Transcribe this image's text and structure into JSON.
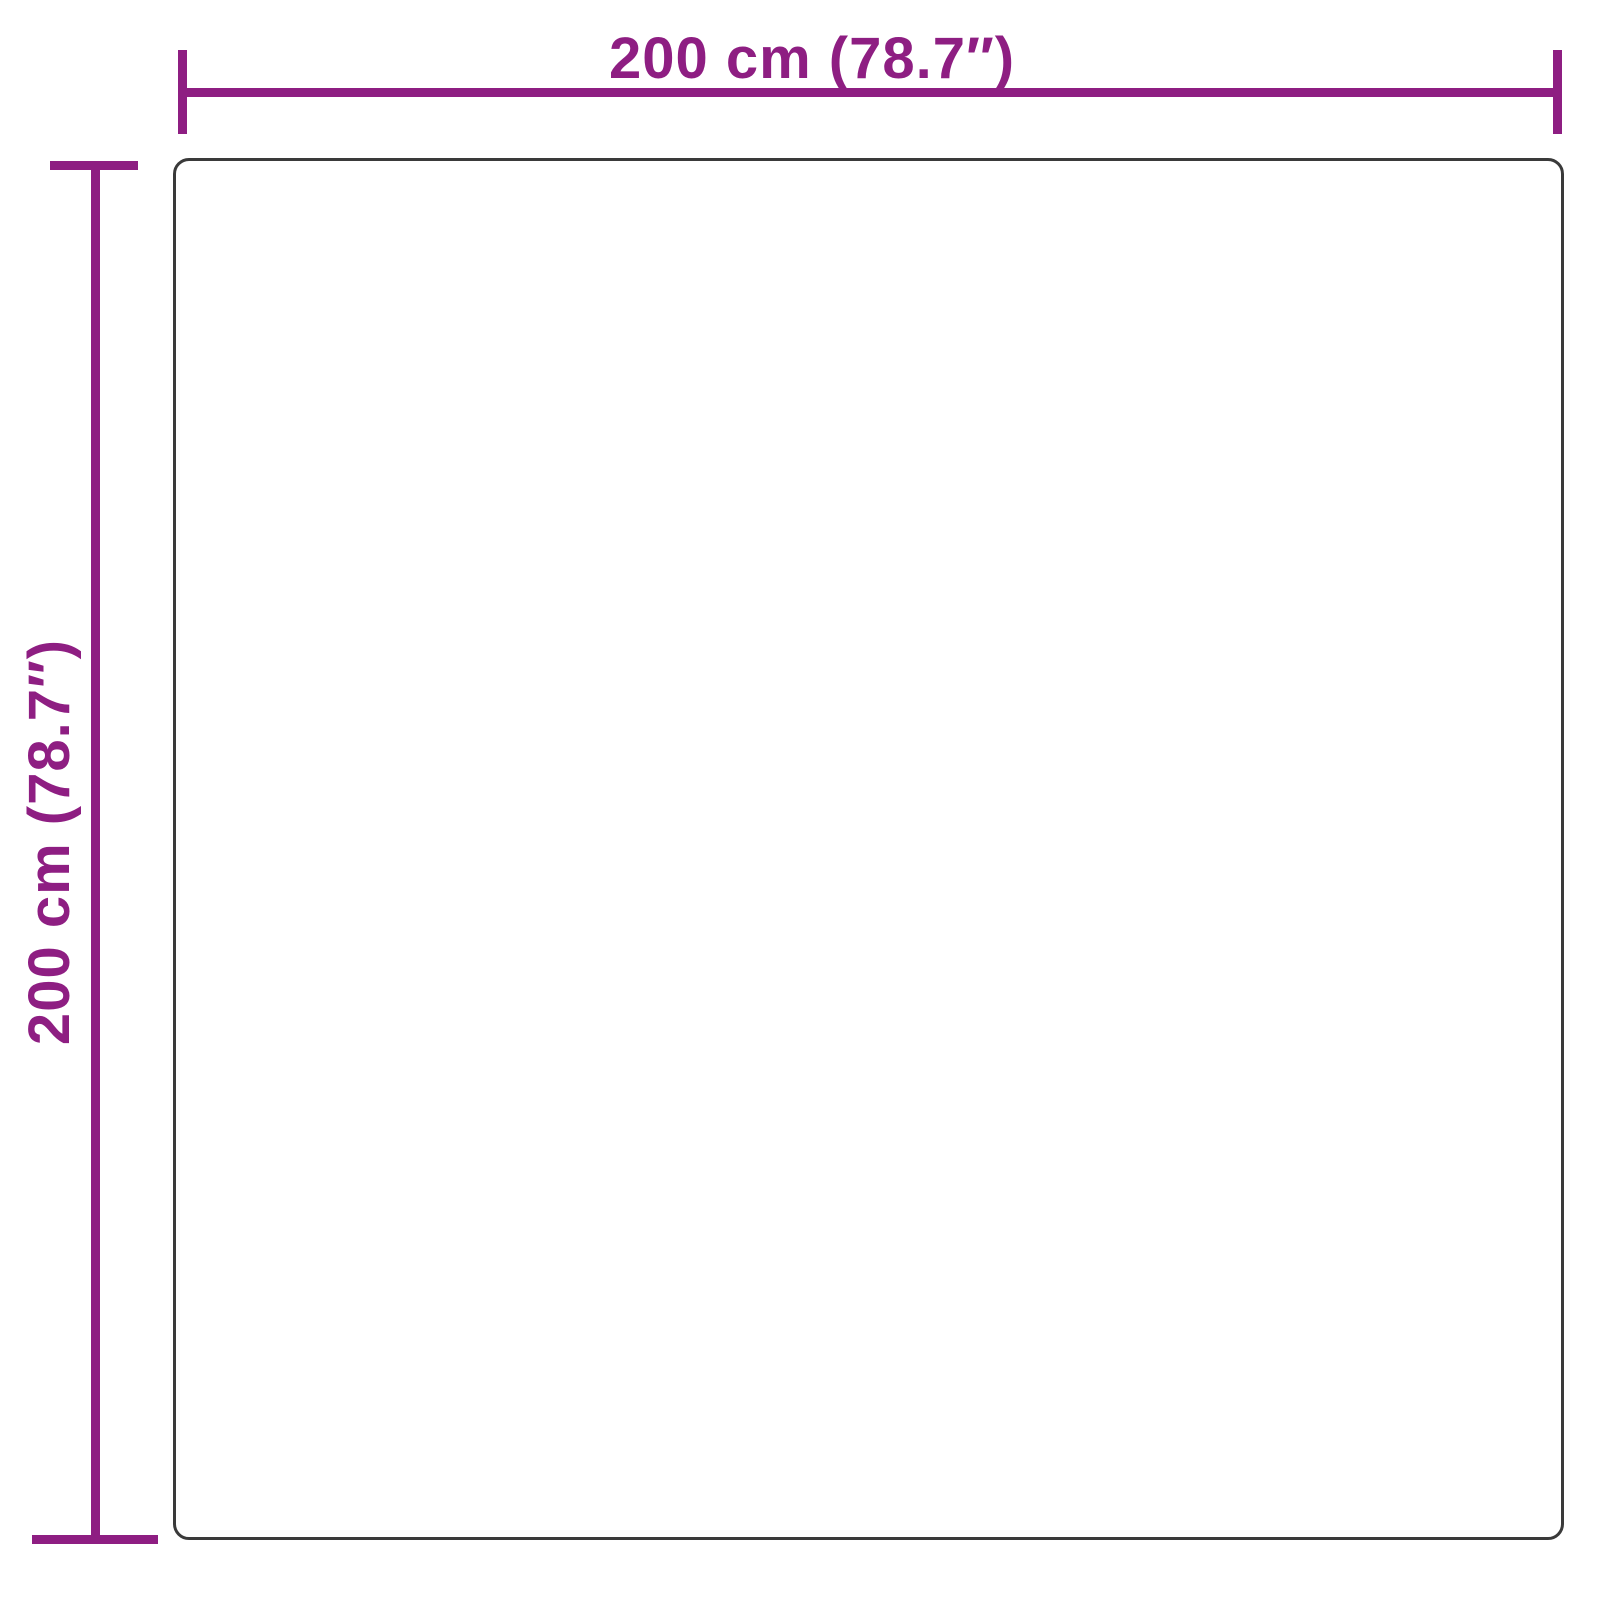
{
  "diagram": {
    "type": "product-dimension-diagram",
    "shape": "square",
    "width_label": "200 cm (78.7″)",
    "height_label": "200 cm (78.7″)",
    "width_value_cm": 200,
    "height_value_cm": 200,
    "width_value_in": 78.7,
    "height_value_in": 78.7,
    "accent_color": "#8E1E82",
    "outline_color": "#3A3A3A",
    "background_color": "#FFFFFF"
  }
}
